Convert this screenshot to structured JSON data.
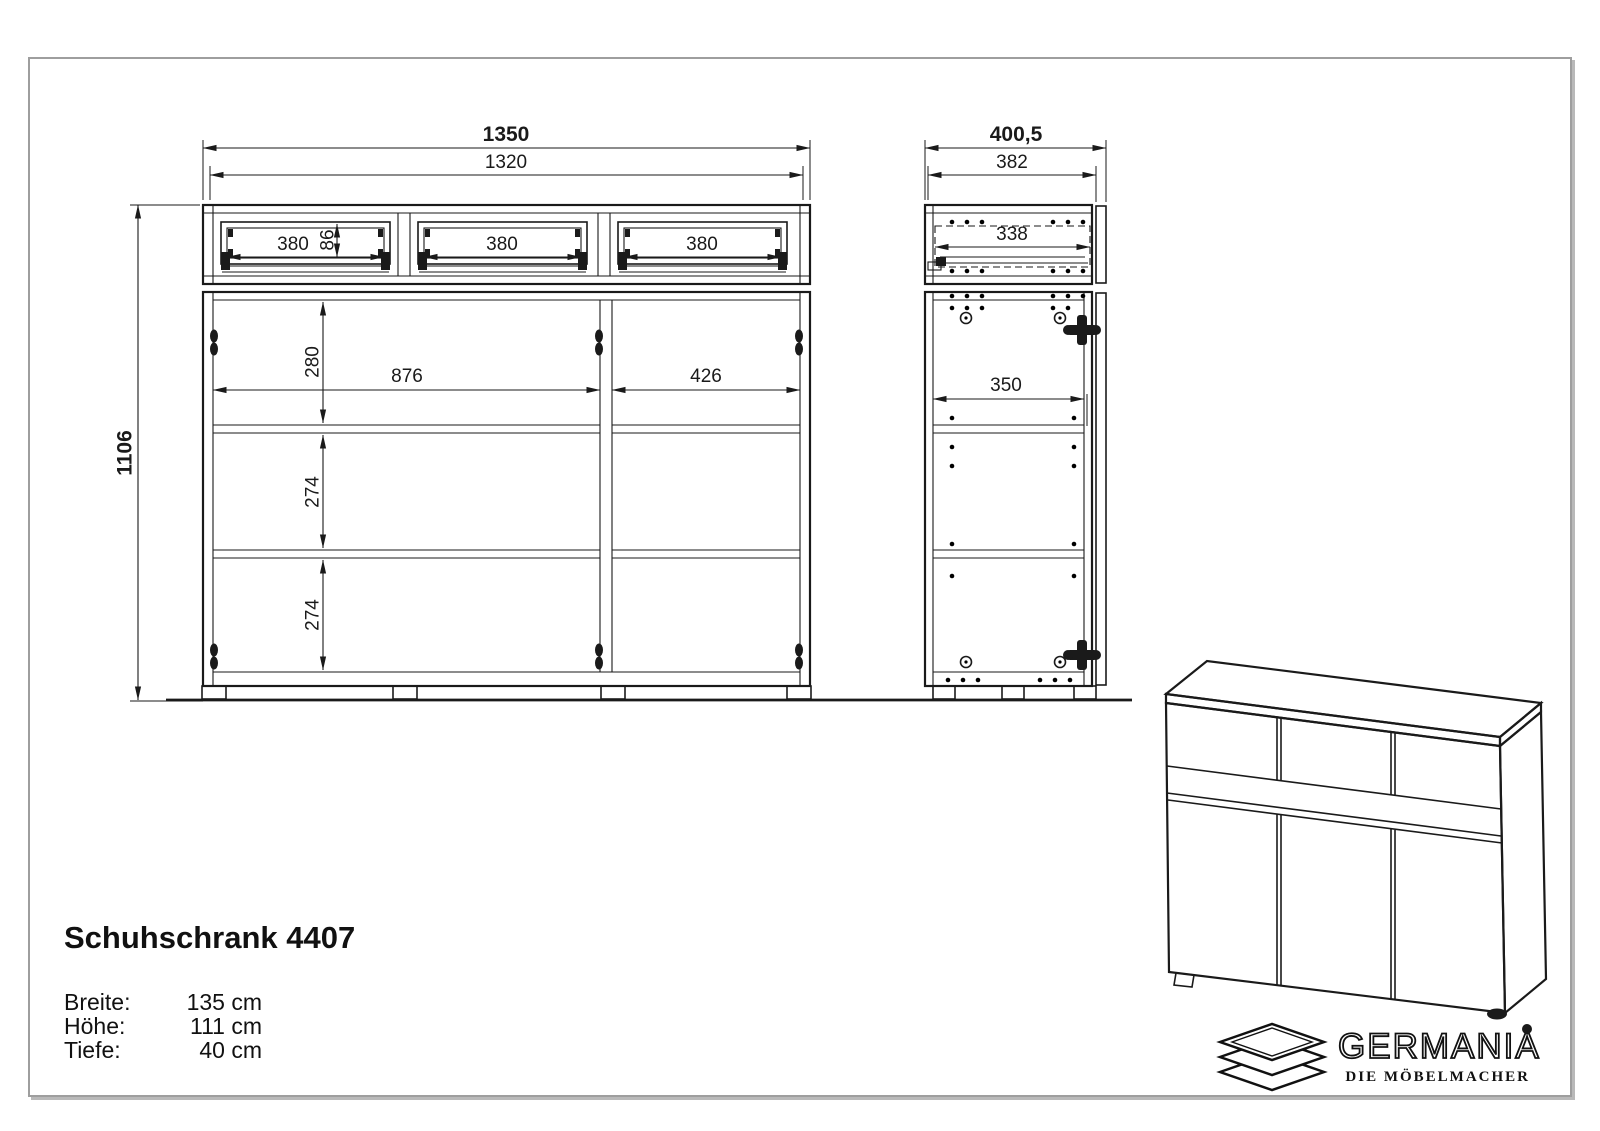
{
  "colors": {
    "line": "#1a1a1a",
    "sheet_border": "#9e9e9e",
    "background": "#ffffff"
  },
  "front_view": {
    "dims": {
      "overall_width": "1350",
      "carcass_width": "1320",
      "overall_height": "1106",
      "drawer1_width": "380",
      "drawer2_width": "380",
      "drawer3_width": "380",
      "drawer_front_height": "86",
      "top_section_height": "280",
      "left_section_width": "876",
      "right_section_width": "426",
      "middle_section_height": "274",
      "bottom_section_height": "274"
    }
  },
  "side_view": {
    "dims": {
      "overall_depth": "400,5",
      "carcass_depth": "382",
      "drawer_depth": "338",
      "shelf_depth": "350"
    }
  },
  "title_block": {
    "product_name": "Schuhschrank 4407",
    "specs": [
      {
        "label": "Breite:",
        "value": "135 cm"
      },
      {
        "label": "Höhe:",
        "value": "111 cm"
      },
      {
        "label": "Tiefe:",
        "value": "40 cm"
      }
    ]
  },
  "brand": {
    "name": "GERMANIA",
    "tagline": "DIE MÖBELMACHER"
  }
}
